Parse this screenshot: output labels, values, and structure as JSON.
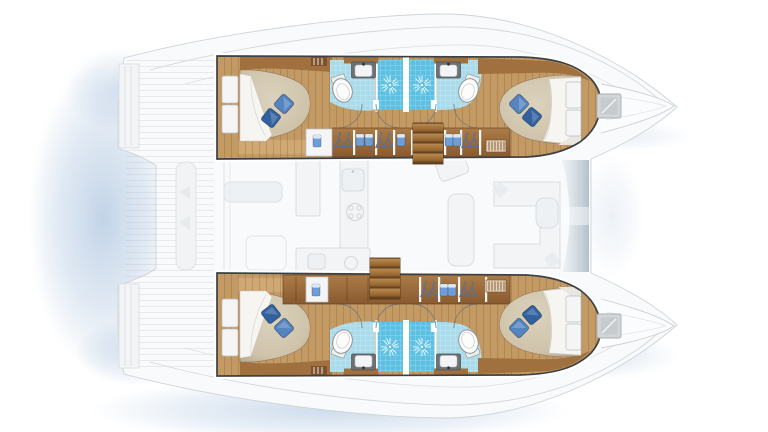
{
  "meta": {
    "description": "Top-view floor plan of a 4-cabin / 4-head sailing catamaran; hull interiors rendered in colour, deck and saloon shown as faint ghost outlines",
    "plan_type": "catamaran-accommodation-layout"
  },
  "layout": {
    "hulls": [
      {
        "position": "top",
        "cabins": [
          {
            "name": "aft-cabin",
            "bed": "double-berth",
            "pillows": 2
          },
          {
            "name": "forward-cabin",
            "bed": "double-berth",
            "pillows": 2
          }
        ],
        "bathrooms": [
          {
            "position": "aft",
            "fixtures": [
              "washbasin",
              "toilet",
              "shower"
            ]
          },
          {
            "position": "forward",
            "fixtures": [
              "shower",
              "washbasin",
              "toilet"
            ]
          }
        ],
        "companionway_steps": 1,
        "wardrobe_hanger_sections": 3,
        "towel_shelves": 4,
        "vent_grilles": 2
      },
      {
        "position": "bottom",
        "cabins": [
          {
            "name": "aft-cabin",
            "bed": "double-berth",
            "pillows": 2
          },
          {
            "name": "forward-cabin",
            "bed": "double-berth",
            "pillows": 2
          }
        ],
        "bathrooms": [
          {
            "position": "aft",
            "fixtures": [
              "washbasin",
              "toilet",
              "shower"
            ]
          },
          {
            "position": "forward",
            "fixtures": [
              "shower",
              "washbasin",
              "toilet"
            ]
          }
        ],
        "companionway_steps": 1,
        "wardrobe_hanger_sections": 2,
        "towel_shelves": 3,
        "vent_grilles": 2
      }
    ],
    "saloon": {
      "rendering": "ghosted",
      "features": [
        "galley-counter",
        "galley-sink",
        "stove",
        "aft-galley-sink",
        "dining-table",
        "u-sofa",
        "settee",
        "nav-seat",
        "windshield"
      ]
    },
    "cockpit": {
      "rendering": "ghosted",
      "features": [
        "cockpit-table",
        "aft-bench",
        "seat-cushions",
        "transom-steps"
      ]
    },
    "foredeck": {
      "deck_hatches": 2,
      "bows": 2
    }
  },
  "totals": {
    "berths": 4,
    "toilets": 4,
    "washbasins": 4,
    "showers": 4,
    "staircases": 2
  },
  "colors": {
    "wood-floor": "#c49a64",
    "wood-floor-light": "#cfa873",
    "wood-cabinet": "#a0713e",
    "wood-cabinet-dark": "#8a5a30",
    "wood-stairs": "#6e4a29",
    "tile-blue": "#a9dbea",
    "shower-blue": "#5cc0e2",
    "towel-blue": "#6f9ed6",
    "pillow-dark": "#31619f",
    "pillow-light": "#5585c0",
    "mattress": "#cfc3aa",
    "sheet": "#f6f5f1",
    "outline": "#3c4145",
    "ghost-line": "#d3d8db",
    "water-shadow": "#9db9d9",
    "fixture-gray": "#6e7174"
  }
}
